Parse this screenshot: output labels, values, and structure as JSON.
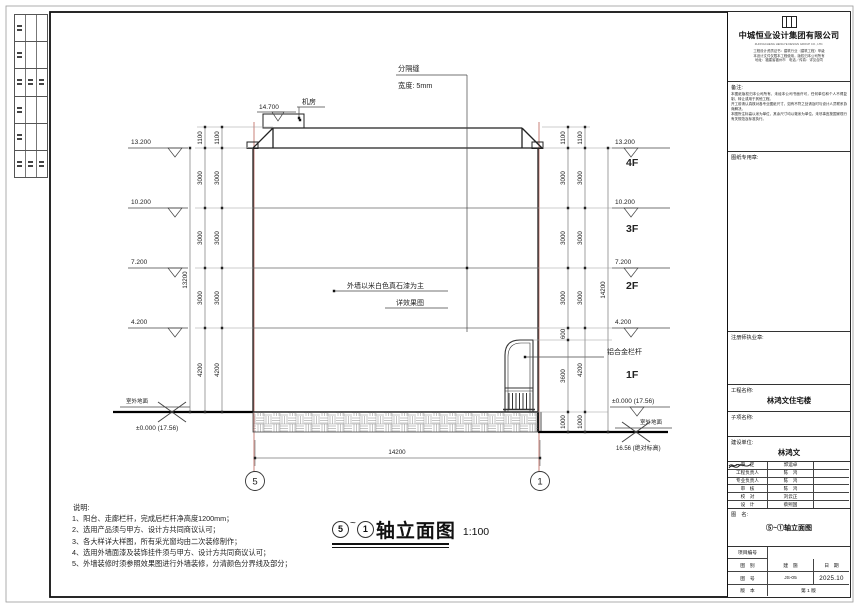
{
  "drawing": {
    "labels": {
      "sep_joint": "分隔缝",
      "sep_width": "宽度: 5mm",
      "machine_room": "机房",
      "lv_top": "14.700",
      "wall_note1": "外墙以米白色真石漆为主",
      "wall_note2": "详效果图",
      "railing": "铝合金栏杆",
      "ground_left": "室外地面",
      "zero_left": "±0.000 (17.56)",
      "zero_right": "±0.000 (17.56)",
      "ground_right": "室外地面",
      "abs_right": "16.56 (绝对标高)"
    },
    "levels": {
      "left": [
        "13.200",
        "10.200",
        "7.200",
        "4.200"
      ],
      "right": [
        "13.200",
        "10.200",
        "7.200",
        "4.200"
      ]
    },
    "floors": [
      "4F",
      "3F",
      "2F",
      "1F"
    ],
    "dims": {
      "left": [
        "1100",
        "3000",
        "3000",
        "3000",
        "4200"
      ],
      "left_total": "13200",
      "right_a": [
        "1100",
        "3000",
        "3000",
        "3000",
        "600",
        "3600",
        "1000"
      ],
      "right_b": [
        "1100",
        "3000",
        "3000",
        "3000",
        "4200",
        "1000"
      ],
      "right_total": "14200",
      "bottom_total": "14200"
    },
    "axes": {
      "left": "5",
      "right": "1"
    }
  },
  "caption": {
    "axis_start": "5",
    "tilde": "~",
    "axis_end": "1",
    "title": "轴立面图",
    "scale": "1:100"
  },
  "notes": {
    "title": "说明:",
    "items": [
      "1、阳台、走廊栏杆，完成后栏杆净高度1200mm；",
      "2、选用产品须与甲方、设计方共同商议认可；",
      "3、各大样详大样图，所有采光窗均由二次装修制作；",
      "4、选用外墙面漆及装饰挂件须与甲方、设计方共同商议认可；",
      "5、外墙装修时须参照效果图进行外墙装修，分清颜色分界线及部分；"
    ]
  },
  "titleblock": {
    "company": {
      "name": "中城恒业设计集团有限公司",
      "english": "ZHONGCHENG HENGYE DESIGN GROUP CO., LTD.",
      "cert_lines": [
        "工程设计资质证书：建筑行业（建筑工程）甲级",
        "本设计文件仅限本工程使用，版权归本公司所有",
        "地址：福建省福州市　电话／传真：详见合同"
      ]
    },
    "remark": {
      "label": "备注:",
      "lines": [
        "本图纸版权归本公司所有，未经本公司书面许可，任何单位和个人不得复制、转让或用于其他工程。",
        "开工前请认真核对各专业图纸尺寸，如有不符之处请及时与设计人员联系协商解决。",
        "本图所注标高以米为单位，其余尺寸均以毫米为单位。未尽事宜按国家现行有关规范及标准执行。"
      ]
    },
    "seal_label": "图纸专用章:",
    "license_label": "注册师执业章:",
    "project_label": "工程名称:",
    "project_name": "林鸿文住宅楼",
    "subitem_label": "子项名称:",
    "client_label": "建设单位:",
    "client_name": "林鸿文",
    "approvals": [
      {
        "role": "审　定",
        "name": "郭运卓"
      },
      {
        "role": "工程负责人",
        "name": "陈　鸿"
      },
      {
        "role": "专业负责人",
        "name": "陈　鸿"
      },
      {
        "role": "审　核",
        "name": "陈　鸿"
      },
      {
        "role": "校　对",
        "name": "刘云正"
      },
      {
        "role": "设　计",
        "name": "蔡熙国"
      }
    ],
    "tuming_label": "图　名:",
    "drawing_name": "⑤~①轴立面图",
    "project_no_label": "项目编号",
    "rows": {
      "tubi_label": "图　别",
      "tubi_value": "建　施",
      "date_label": "日　期",
      "tuhao_label": "图　号",
      "tuhao_value": "JS-05",
      "date_value": "2025.10",
      "version_label": "版　本",
      "version_value": "第 1 版"
    }
  }
}
